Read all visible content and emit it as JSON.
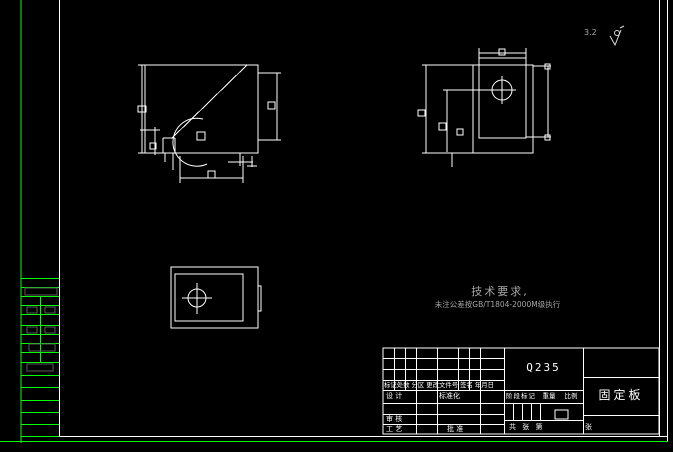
{
  "app": {
    "type": "cad-drawing-sheet"
  },
  "colors": {
    "background": "#000000",
    "frame_green": "#00ff00",
    "drawing_white": "#ffffff",
    "dim_gray_boxes": "#5a5a5a",
    "note_gray": "#a6a6a6"
  },
  "corner_note": {
    "roughness_value": "3.2",
    "symbol": "surface-roughness-check"
  },
  "tech_requirements": {
    "title": "技术要求,",
    "line1": "未注公差按GB/T1804-2000M级执行"
  },
  "title_block": {
    "material": "Q235",
    "part_name": "固定板",
    "revision_header": "标记处数 分区 更改文件号 签名 年月日",
    "design_label": "设 计",
    "standardization_label": "标准化",
    "check_label": "审 核",
    "process_label": "工 艺",
    "approve_label": "批 准",
    "stage_mark_label": "阶段标记",
    "weight_label": "重量",
    "scale_label": "比例",
    "sheet_count_label": "共  张 第",
    "sheet_unit_label": "张"
  }
}
